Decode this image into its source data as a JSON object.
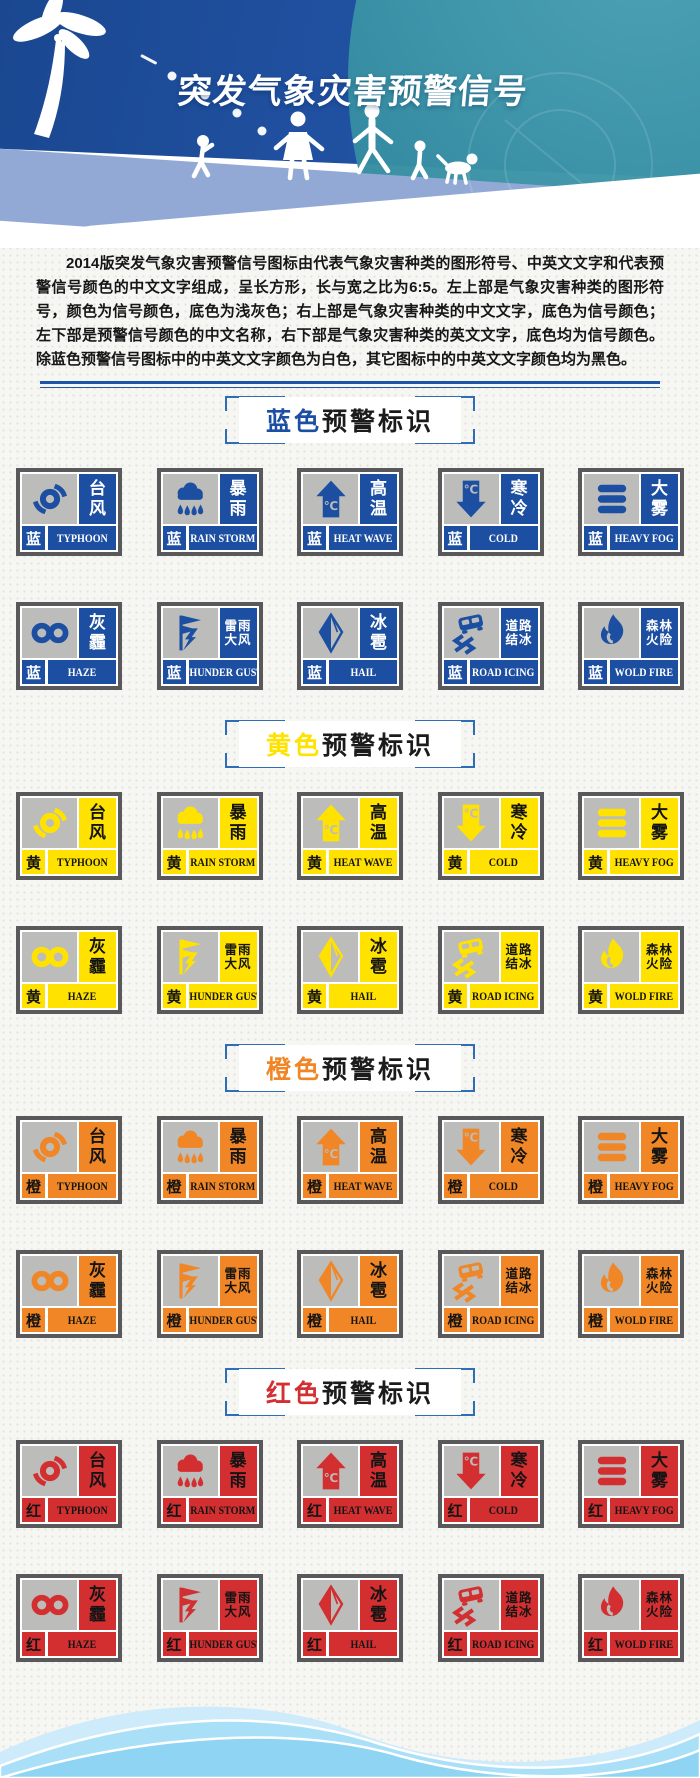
{
  "page": {
    "title": "突发气象灾害预警信号",
    "intro": "2014版突发气象灾害预警信号图标由代表气象灾害种类的图形符号、中英文文字和代表预警信号颜色的中文文字组成，呈长方形，长与宽之比为6:5。左上部是气象灾害种类的图形符号，颜色为信号颜色，底色为浅灰色；右上部是气象灾害种类的中文文字，底色为信号颜色；左下部是预警信号颜色的中文名称，右下部是气象灾害种类的英文文字，底色均为信号颜色。除蓝色预警信号图标中的中英文文字颜色为白色，其它图标中的中英文文字颜色均为黑色。"
  },
  "header_icons": [
    "palm-tree-icon",
    "walking-family-icon",
    "satellite-dish-icon"
  ],
  "signal_types": [
    {
      "id": "typhoon",
      "zh": "台风",
      "en": "TYPHOON",
      "icon": "typhoon-icon"
    },
    {
      "id": "rainstorm",
      "zh": "暴雨",
      "en": "RAIN STORM",
      "icon": "rainstorm-icon"
    },
    {
      "id": "heatwave",
      "zh": "高温",
      "en": "HEAT WAVE",
      "icon": "heat-wave-arrow-icon"
    },
    {
      "id": "cold",
      "zh": "寒冷",
      "en": "COLD",
      "icon": "cold-arrow-icon"
    },
    {
      "id": "fog",
      "zh": "大雾",
      "en": "HEAVY FOG",
      "icon": "fog-bars-icon"
    },
    {
      "id": "haze",
      "zh": "灰霾",
      "en": "HAZE",
      "icon": "haze-infinity-icon"
    },
    {
      "id": "thunder",
      "zh": "雷雨大风",
      "en": "THUNDER GUST",
      "icon": "thunder-flag-icon"
    },
    {
      "id": "hail",
      "zh": "冰雹",
      "en": "HAIL",
      "icon": "hail-crystal-icon"
    },
    {
      "id": "roadicing",
      "zh": "道路结冰",
      "en": "ROAD ICING",
      "icon": "skidding-car-icon"
    },
    {
      "id": "forestfire",
      "zh": "森林火险",
      "en": "WOLD FIRE",
      "icon": "flame-icon"
    }
  ],
  "sections": [
    {
      "id": "blue",
      "title_color_word": "蓝色",
      "title_rest": "预警标识",
      "level_char": "蓝",
      "color": "#1c4fa1",
      "text_color": "#ffffff"
    },
    {
      "id": "yellow",
      "title_color_word": "黄色",
      "title_rest": "预警标识",
      "level_char": "黄",
      "color": "#ffe200",
      "text_color": "#141414"
    },
    {
      "id": "orange",
      "title_color_word": "橙色",
      "title_rest": "预警标识",
      "level_char": "橙",
      "color": "#f08625",
      "text_color": "#141414"
    },
    {
      "id": "red",
      "title_color_word": "红色",
      "title_rest": "预警标识",
      "level_char": "红",
      "color": "#d32f31",
      "text_color": "#141414"
    }
  ],
  "colors": {
    "blue_signal": "#1c4fa1",
    "yellow_signal": "#ffe200",
    "orange_signal": "#f08625",
    "red_signal": "#d32f31",
    "sign_frame": "#59595b",
    "icon_background": "#bcbcba",
    "header_blue": "#2152a3",
    "header_teal": "#328a9f",
    "header_periwinkle": "#92a9d6",
    "bracket_blue": "#2f6db6",
    "footer_wave_light": "#cdebfa",
    "footer_wave_mid": "#a9dff7",
    "footer_wave_deep": "#8fd5f3"
  }
}
